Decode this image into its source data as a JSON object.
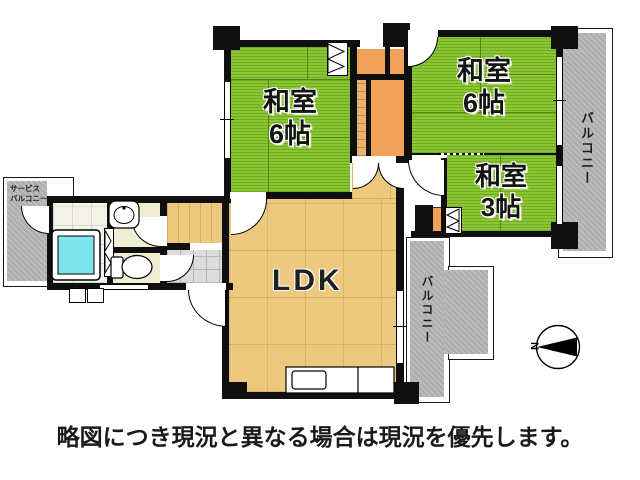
{
  "plan": {
    "rooms": {
      "washitsu_left": {
        "line1": "和室",
        "line2": "6帖"
      },
      "washitsu_right": {
        "line1": "和室",
        "line2": "6帖"
      },
      "washitsu_small": {
        "line1": "和室",
        "line2": "3帖"
      },
      "ldk": {
        "label": "LDK"
      }
    },
    "balconies": {
      "right": {
        "label": "バルコニー"
      },
      "bottom": {
        "label": "バルコニー"
      },
      "service": {
        "line1": "サービス",
        "line2": "バルコニー"
      }
    },
    "compass": {
      "north_label": "N"
    },
    "caption": {
      "text": "略図につき現況と異なる場合は現況を優先します。"
    },
    "colors": {
      "tatami_green": "#8bc532",
      "closet_orange": "#efa258",
      "wood_floor": "#ecc97f",
      "cream_room": "#f0eed2",
      "bathtub_cyan": "#7fe4ee",
      "balcony_gray": "#b5b5b5",
      "wall_black": "#0f0f0f"
    }
  }
}
